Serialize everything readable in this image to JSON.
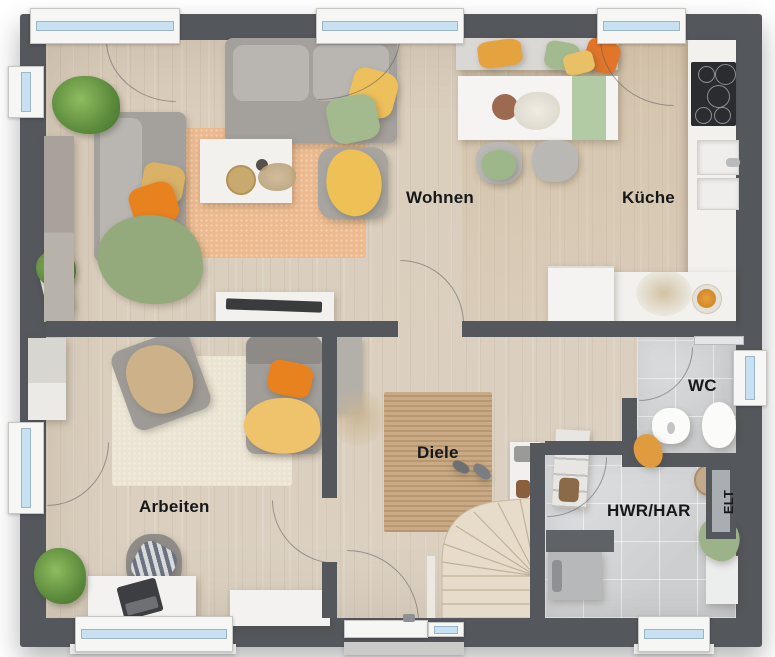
{
  "type": "floor-plan-top-view",
  "labels": {
    "wohnen": "Wohnen",
    "kueche": "Küche",
    "arbeiten": "Arbeiten",
    "diele": "Diele",
    "wc": "WC",
    "hwr_har": "HWR/HAR",
    "elt": "ELT"
  },
  "colors": {
    "wall": "#54575c",
    "floor-wood": "#dcd2c3",
    "floor-tile": "#d5d6d8",
    "window-glass": "#c7e1f3",
    "rug-living": "#ecba8e",
    "rug-work": "#ebe4d3",
    "rug-jute": "#c2a178",
    "sofa-gray": "#a4a19c",
    "pillow-orange": "#e8821f",
    "pillow-yellow": "#eec05b",
    "pillow-green": "#a3ba8f",
    "counter-white": "#f2f1ee",
    "stairs-wood": "#e7dcc9",
    "label-text": "#17181a"
  }
}
